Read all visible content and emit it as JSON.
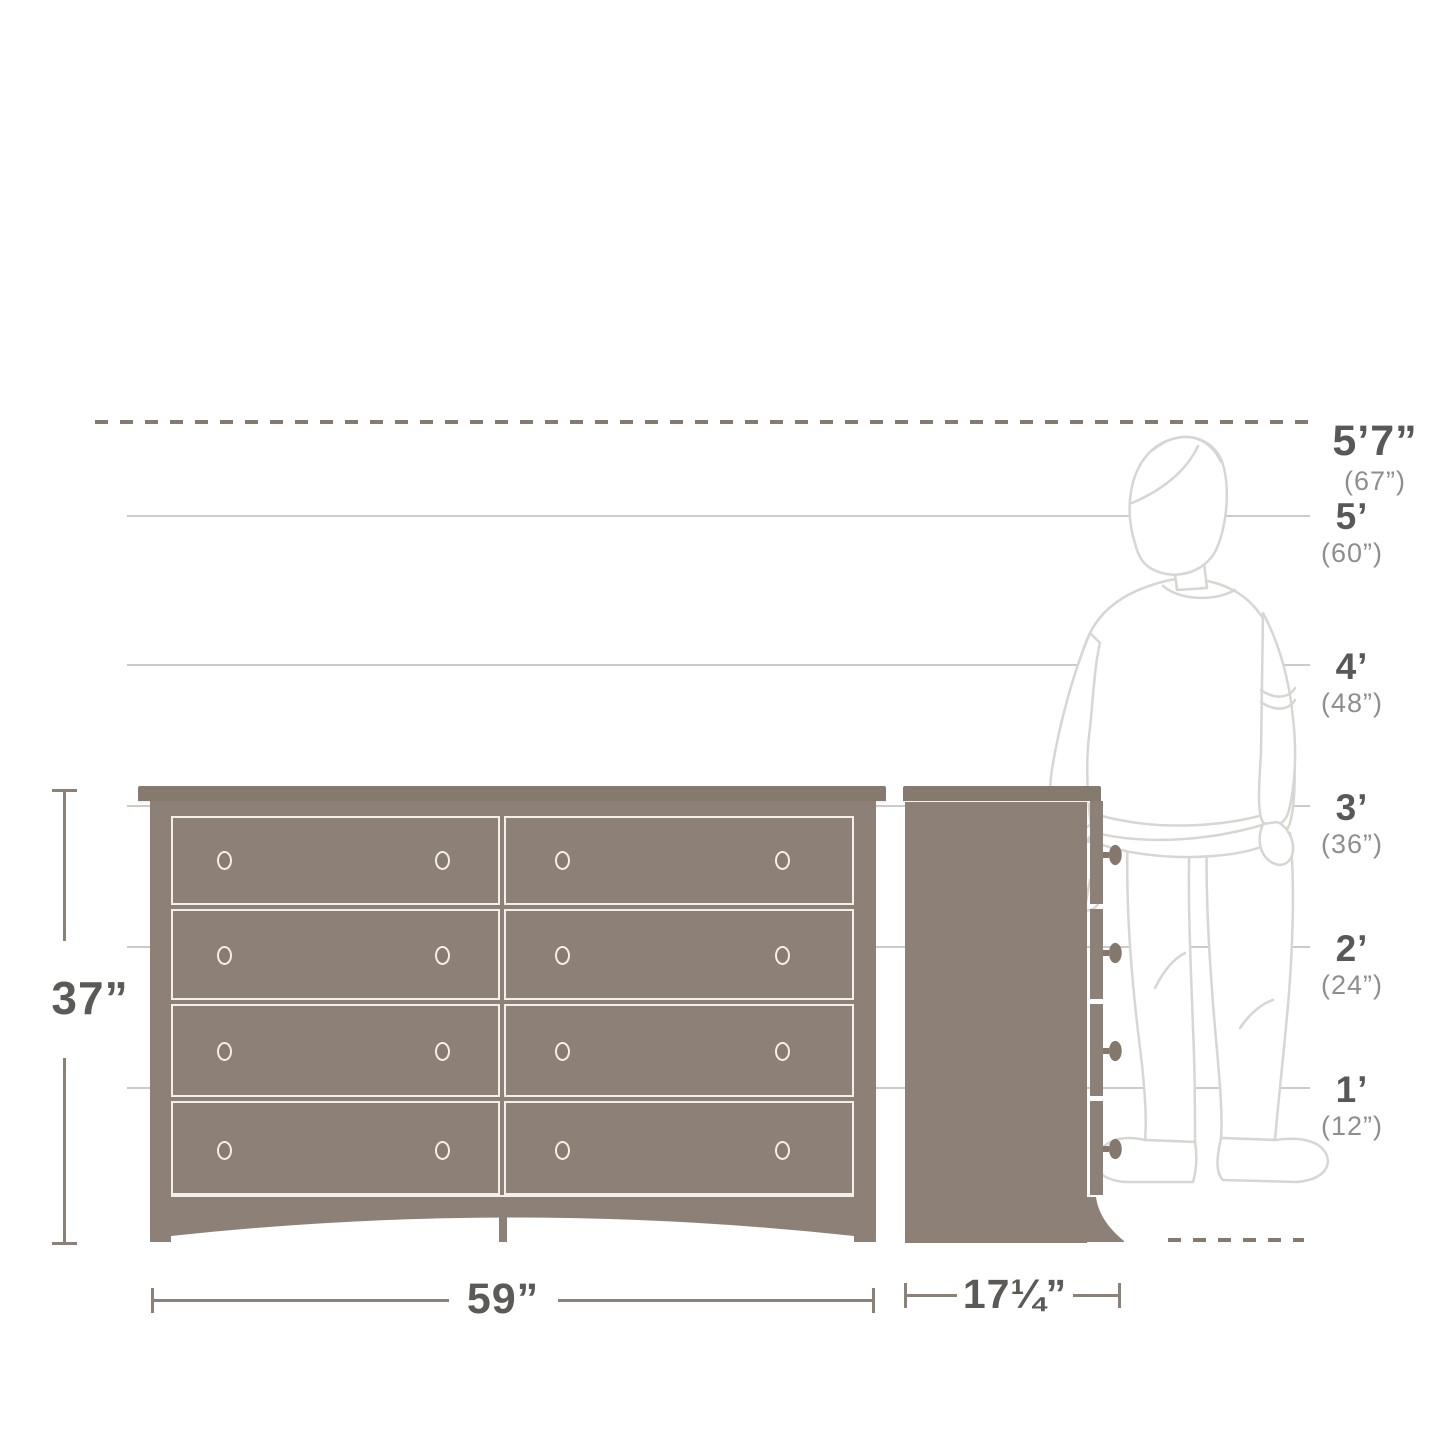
{
  "height_markers": [
    {
      "label": "5’7”",
      "sub": "(67”)"
    },
    {
      "label": "5’",
      "sub": "(60”)"
    },
    {
      "label": "4’",
      "sub": "(48”)"
    },
    {
      "label": "3’",
      "sub": "(36”)"
    },
    {
      "label": "2’",
      "sub": "(24”)"
    },
    {
      "label": "1’",
      "sub": "(12”)"
    }
  ],
  "dimensions": {
    "height": "37”",
    "width": "59”",
    "depth": "17¼”"
  },
  "product": {
    "type": "8-drawer double dresser",
    "views": [
      "front",
      "side"
    ],
    "reference_figure": "standing adult, 5 ft 7 in"
  },
  "colors": {
    "dresser_body": "#8d8177",
    "dresser_outline": "#f3f0ec",
    "reference_line": "#cdcbc9",
    "dashed_line": "#86796e",
    "dimension_line": "#8c8177",
    "label_main": "#58585a",
    "label_sub": "#8e8e8e",
    "figure_outline": "#d8d6d2"
  }
}
